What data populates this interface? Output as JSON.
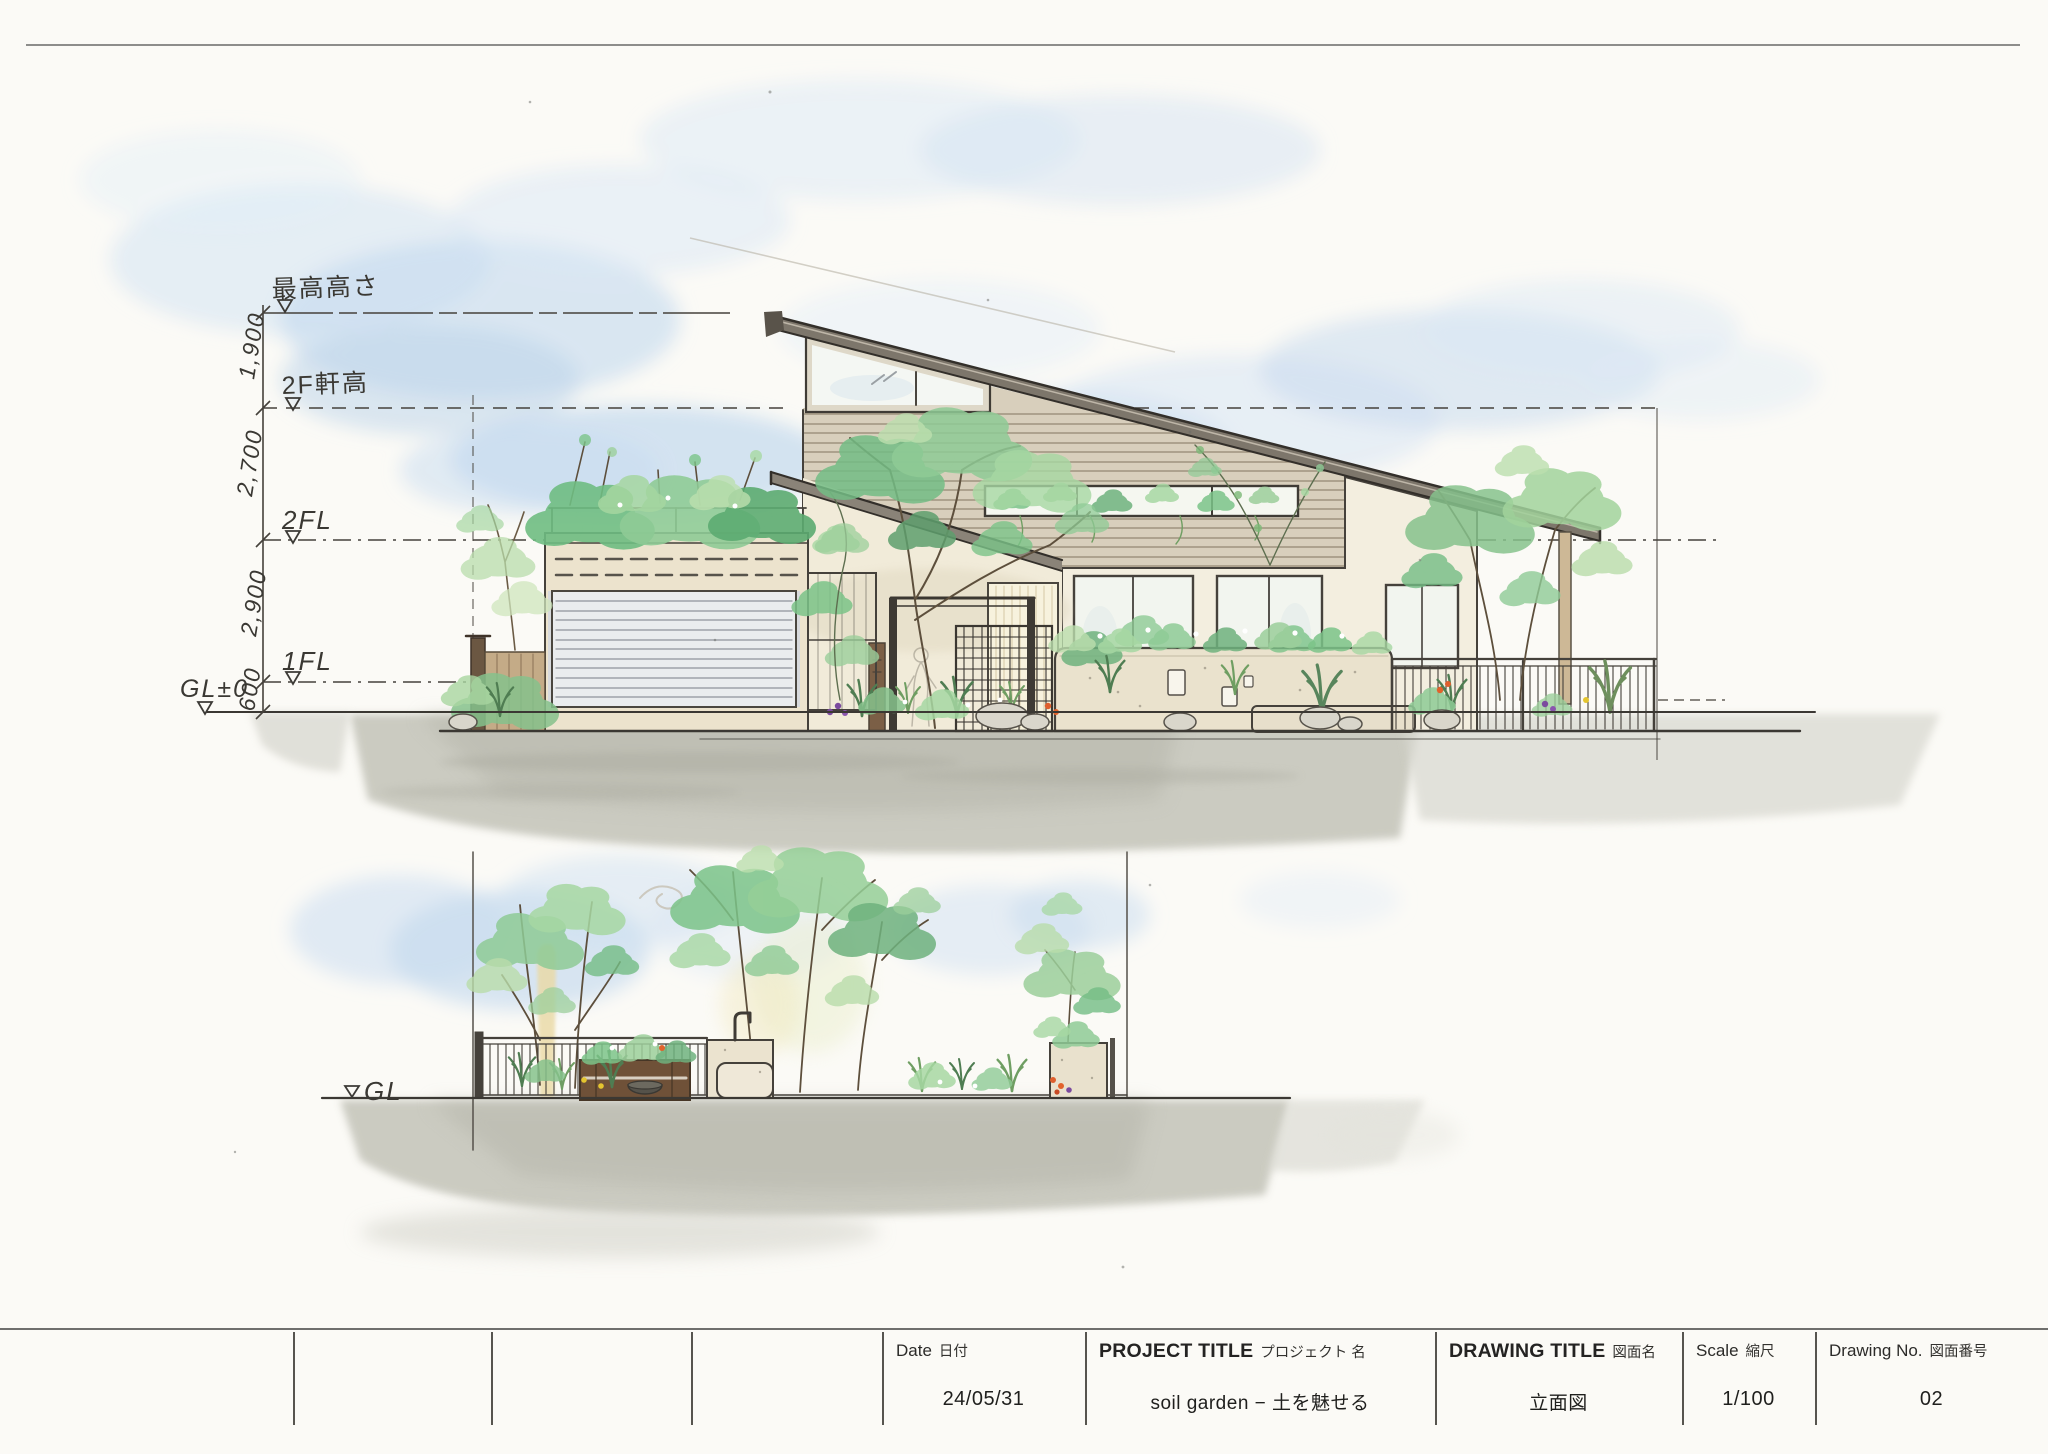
{
  "palette": {
    "paper": "#fbfaf6",
    "sky": "#c9dbee",
    "sky_deep": "#b9d3ec",
    "ink": "#45413b",
    "wall_cream": "#f3eedf",
    "siding_tan": "#d8cfbc",
    "roof_gray": "#7d766b",
    "shutter_gray": "#eaecee",
    "green": "#8fcb96",
    "green_deep": "#5fa974",
    "green_light": "#bcdfae",
    "trunk_brown": "#6b5b45",
    "ground_gray": "#c6c6bc",
    "flower_purple": "#7b4a9e",
    "flower_orange": "#df5f2d",
    "flower_yellow": "#e4c52f"
  },
  "upper_elevation": {
    "levels": {
      "max": "最高高さ",
      "eave": "2F軒高",
      "fl2": "2FL",
      "fl1": "1FL",
      "gl": "GL±0"
    },
    "dims": [
      "1,900",
      "2,700",
      "2,900",
      "600"
    ]
  },
  "lower_elevation": {
    "gl": "GL"
  },
  "title_block": {
    "cells": [
      {
        "label_en": "Date",
        "label_ja": "日付",
        "value": "24/05/31"
      },
      {
        "label_en": "PROJECT TITLE",
        "label_ja": "プロジェクト 名",
        "value": "soil garden − 土を魅せる"
      },
      {
        "label_en": "DRAWING TITLE",
        "label_ja": "図面名",
        "value": "立面図"
      },
      {
        "label_en": "Scale",
        "label_ja": "縮尺",
        "value": "1/100"
      },
      {
        "label_en": "Drawing No.",
        "label_ja": "図面番号",
        "value": "02"
      }
    ]
  }
}
